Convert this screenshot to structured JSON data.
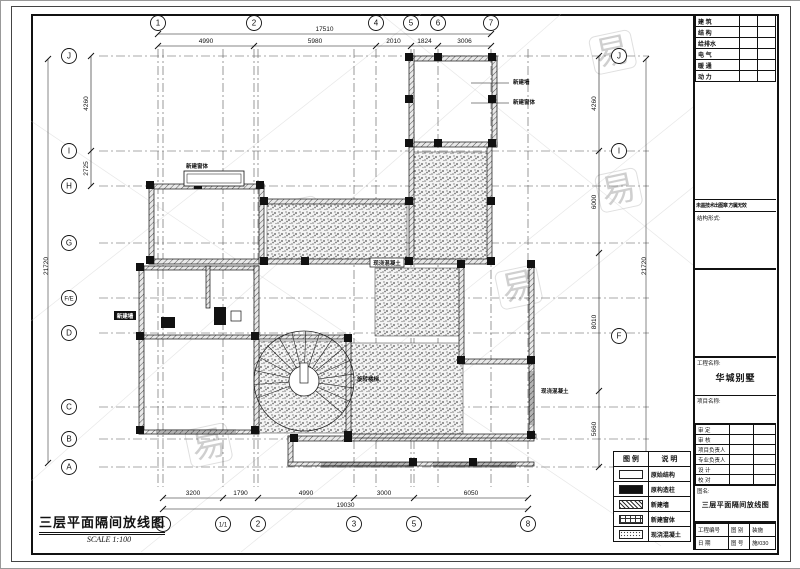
{
  "drawing": {
    "title": "三层平面隔间放线图",
    "scale_text": "SCALE 1:100"
  },
  "watermark": {
    "char": "易"
  },
  "grid": {
    "top_labels": [
      "1",
      "2",
      "4",
      "5",
      "6",
      "7"
    ],
    "bottom_labels": [
      "1",
      "1/1",
      "2",
      "3",
      "5",
      "8"
    ],
    "left_labels": [
      "J",
      "I",
      "H",
      "G",
      "F/E",
      "D",
      "C",
      "B",
      "A"
    ],
    "right_labels": [
      "J",
      "I",
      "F"
    ]
  },
  "dims": {
    "top_total": "17510",
    "top_segments": [
      "4990",
      "5980",
      "2010",
      "1824",
      "3006"
    ],
    "bottom_total": "19030",
    "bottom_segments": [
      "3200",
      "1790",
      "4990",
      "3000",
      "6050"
    ],
    "left_segments": [
      "4260",
      "2725"
    ],
    "left_total": "21720",
    "right_segments": [
      "4260",
      "6000",
      "8010",
      "5660"
    ],
    "right_total": "21720"
  },
  "plan_labels": [
    {
      "text": "新建墙"
    },
    {
      "text": "新建窗体"
    },
    {
      "text": "新建窗体"
    },
    {
      "text": "现浇混凝土"
    },
    {
      "text": "旋转楼梯"
    },
    {
      "text": "现浇混凝土"
    },
    {
      "text": "新建墙"
    }
  ],
  "legend": {
    "header_symbol": "图 例",
    "header_desc": "说 明",
    "rows": [
      {
        "label": "原始结构"
      },
      {
        "label": "原构造柱"
      },
      {
        "label": "新建墙"
      },
      {
        "label": "新建窗体"
      },
      {
        "label": "现浇混凝土"
      }
    ]
  },
  "title_block": {
    "disciplines": [
      "建 筑",
      "结 构",
      "给排水",
      "电 气",
      "暖 通",
      "动 力"
    ],
    "stamp_note": "未盖技术出图章 方属无效",
    "form_label": "结构形式:",
    "project_label": "工程名称:",
    "project_value": "华城别墅",
    "item_label": "项目名称:",
    "sign_rows": [
      "审  定",
      "审  核",
      "项目负责人",
      "专业负责人",
      "设  计",
      "校  对"
    ],
    "drawing_name_label": "图名:",
    "drawing_name": "三层平面隔间放线图",
    "footer": {
      "no_label": "工程编号",
      "date_label": "日  期",
      "type_label": "图 别",
      "type_value": "装施",
      "sheet_label": "图 号",
      "sheet_value": "施/030"
    }
  }
}
